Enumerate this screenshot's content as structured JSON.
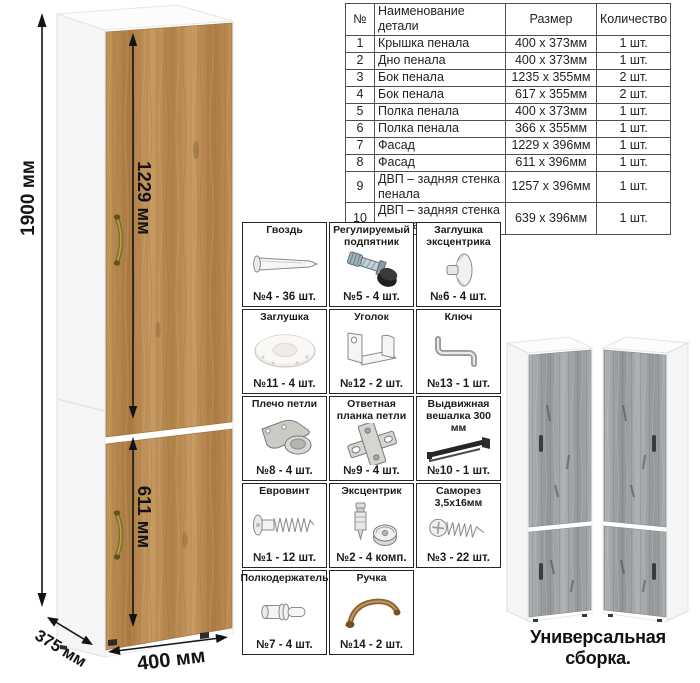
{
  "parts_table": {
    "headers": [
      "№",
      "Наименование детали",
      "Размер",
      "Количество"
    ],
    "rows": [
      [
        "1",
        "Крышка пенала",
        "400 х 373мм",
        "1 шт."
      ],
      [
        "2",
        "Дно пенала",
        "400 х 373мм",
        "1 шт."
      ],
      [
        "3",
        "Бок пенала",
        "1235 х 355мм",
        "2 шт."
      ],
      [
        "4",
        "Бок пенала",
        "617 х 355мм",
        "2 шт."
      ],
      [
        "5",
        "Полка пенала",
        "400 х 373мм",
        "1 шт."
      ],
      [
        "6",
        "Полка пенала",
        "366 х 355мм",
        "1 шт."
      ],
      [
        "7",
        "Фасад",
        "1229 х 396мм",
        "1 шт."
      ],
      [
        "8",
        "Фасад",
        "611 х 396мм",
        "1 шт."
      ],
      [
        "9",
        "ДВП – задняя стенка пенала",
        "1257 х 396мм",
        "1 шт."
      ],
      [
        "10",
        "ДВП – задняя стенка пенала",
        "639 х 396мм",
        "1 шт."
      ]
    ]
  },
  "dimensions": {
    "height": "1900 мм",
    "upper_door": "1229 мм",
    "lower_door": "611 мм",
    "width": "400 мм",
    "depth": "375 мм"
  },
  "hardware": [
    {
      "name": "Гвоздь",
      "qty": "№4 - 36 шт.",
      "icon": "nail-icon"
    },
    {
      "name": "Регулируемый подпятник",
      "qty": "№5 - 4 шт.",
      "icon": "adjustable-foot-icon"
    },
    {
      "name": "Заглушка эксцентрика",
      "qty": "№6 - 4 шт.",
      "icon": "cam-cap-icon"
    },
    {
      "name": "Заглушка",
      "qty": "№11 - 4 шт.",
      "icon": "plug-icon"
    },
    {
      "name": "Уголок",
      "qty": "№12 - 2 шт.",
      "icon": "corner-bracket-icon"
    },
    {
      "name": "Ключ",
      "qty": "№13 - 1 шт.",
      "icon": "hex-key-icon"
    },
    {
      "name": "Плечо петли",
      "qty": "№8 - 4 шт.",
      "icon": "hinge-arm-icon"
    },
    {
      "name": "Ответная планка петли",
      "qty": "№9 - 4 шт.",
      "icon": "hinge-plate-icon"
    },
    {
      "name": "Выдвижная вешалка 300 мм",
      "qty": "№10 - 1 шт.",
      "icon": "pullout-hanger-icon"
    },
    {
      "name": "Евровинт",
      "qty": "№1 - 12 шт.",
      "icon": "euro-screw-icon"
    },
    {
      "name": "Эксцентрик",
      "qty": "№2 - 4 комп.",
      "icon": "cam-lock-icon"
    },
    {
      "name": "Саморез 3,5х16мм",
      "qty": "№3 - 22 шт.",
      "icon": "self-tapping-screw-icon"
    },
    {
      "name": "Полкодержатель",
      "qty": "№7 - 4 шт.",
      "icon": "shelf-pin-icon"
    },
    {
      "name": "Ручка",
      "qty": "№14 - 2 шт.",
      "icon": "handle-icon"
    }
  ],
  "footer": {
    "caption": "Универсальная сборка."
  },
  "colors": {
    "wood": "#b5854f",
    "wood_dark": "#8a6231",
    "gray_wood": "#a6a9ab",
    "handle_bronze": "#8a6433",
    "arrow": "#141414",
    "table_border": "#4f4f4f",
    "foot_black": "#1f1f1f"
  }
}
